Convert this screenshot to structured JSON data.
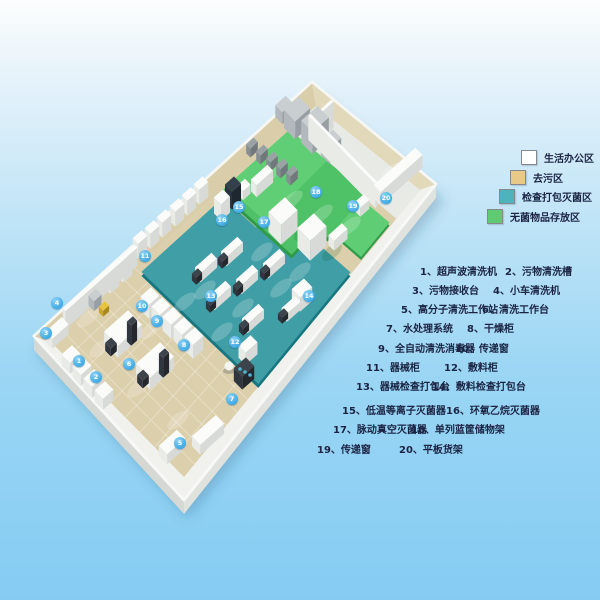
{
  "legend": [
    {
      "label": "生活办公区",
      "color": "#ffffff"
    },
    {
      "label": "去污区",
      "color": "#e8c987"
    },
    {
      "label": "检查打包灭菌区",
      "color": "#4fb3bb"
    },
    {
      "label": "无菌物品存放区",
      "color": "#5ecb72"
    }
  ],
  "equipment": [
    {
      "n": 1,
      "label": "超声波清洗机"
    },
    {
      "n": 2,
      "label": "污物清洗槽"
    },
    {
      "n": 3,
      "label": "污物接收台"
    },
    {
      "n": 4,
      "label": "小车清洗机"
    },
    {
      "n": 5,
      "label": "高分子清洗工作站"
    },
    {
      "n": 6,
      "label": "清洗工作台"
    },
    {
      "n": 7,
      "label": "水处理系统"
    },
    {
      "n": 8,
      "label": "干燥柜"
    },
    {
      "n": 9,
      "label": "全自动清洗消毒器"
    },
    {
      "n": 10,
      "label": "传递窗"
    },
    {
      "n": 11,
      "label": "器械柜"
    },
    {
      "n": 12,
      "label": "敷料柜"
    },
    {
      "n": 13,
      "label": "器械检查打包台"
    },
    {
      "n": 14,
      "label": "敷料检查打包台"
    },
    {
      "n": 15,
      "label": "低温等离子灭菌器"
    },
    {
      "n": 16,
      "label": "环氧乙烷灭菌器"
    },
    {
      "n": 17,
      "label": "脉动真空灭菌器"
    },
    {
      "n": 18,
      "label": "单列蓝筐储物架"
    },
    {
      "n": 19,
      "label": "传递窗"
    },
    {
      "n": 20,
      "label": "平板货架"
    }
  ],
  "markers": [
    {
      "n": 1,
      "x": 79,
      "y": 361
    },
    {
      "n": 2,
      "x": 96,
      "y": 377
    },
    {
      "n": 3,
      "x": 46,
      "y": 333
    },
    {
      "n": 4,
      "x": 57,
      "y": 303
    },
    {
      "n": 5,
      "x": 180,
      "y": 443
    },
    {
      "n": 6,
      "x": 129,
      "y": 364
    },
    {
      "n": 7,
      "x": 232,
      "y": 399
    },
    {
      "n": 8,
      "x": 184,
      "y": 345
    },
    {
      "n": 9,
      "x": 157,
      "y": 321
    },
    {
      "n": 10,
      "x": 142,
      "y": 306
    },
    {
      "n": 11,
      "x": 145,
      "y": 256
    },
    {
      "n": 12,
      "x": 235,
      "y": 342
    },
    {
      "n": 13,
      "x": 211,
      "y": 296
    },
    {
      "n": 14,
      "x": 309,
      "y": 296
    },
    {
      "n": 15,
      "x": 239,
      "y": 207
    },
    {
      "n": 16,
      "x": 222,
      "y": 220
    },
    {
      "n": 17,
      "x": 264,
      "y": 222
    },
    {
      "n": 18,
      "x": 316,
      "y": 192
    },
    {
      "n": 19,
      "x": 353,
      "y": 206
    },
    {
      "n": 20,
      "x": 386,
      "y": 198
    }
  ],
  "colors": {
    "background_top": "#fcfdfd",
    "background_bottom": "#85ccf3",
    "zone_decontamination": "#dccfab",
    "zone_inspection_packing": "#3f9ea6",
    "zone_sterile_storage": "#4fc167",
    "zone_far_section": "#e8eae6",
    "marker_blue": "#3aa8e4",
    "text_dark": "#1c2444",
    "wall_tan": "#d9cea9",
    "wall_white": "#f1f2ee"
  }
}
